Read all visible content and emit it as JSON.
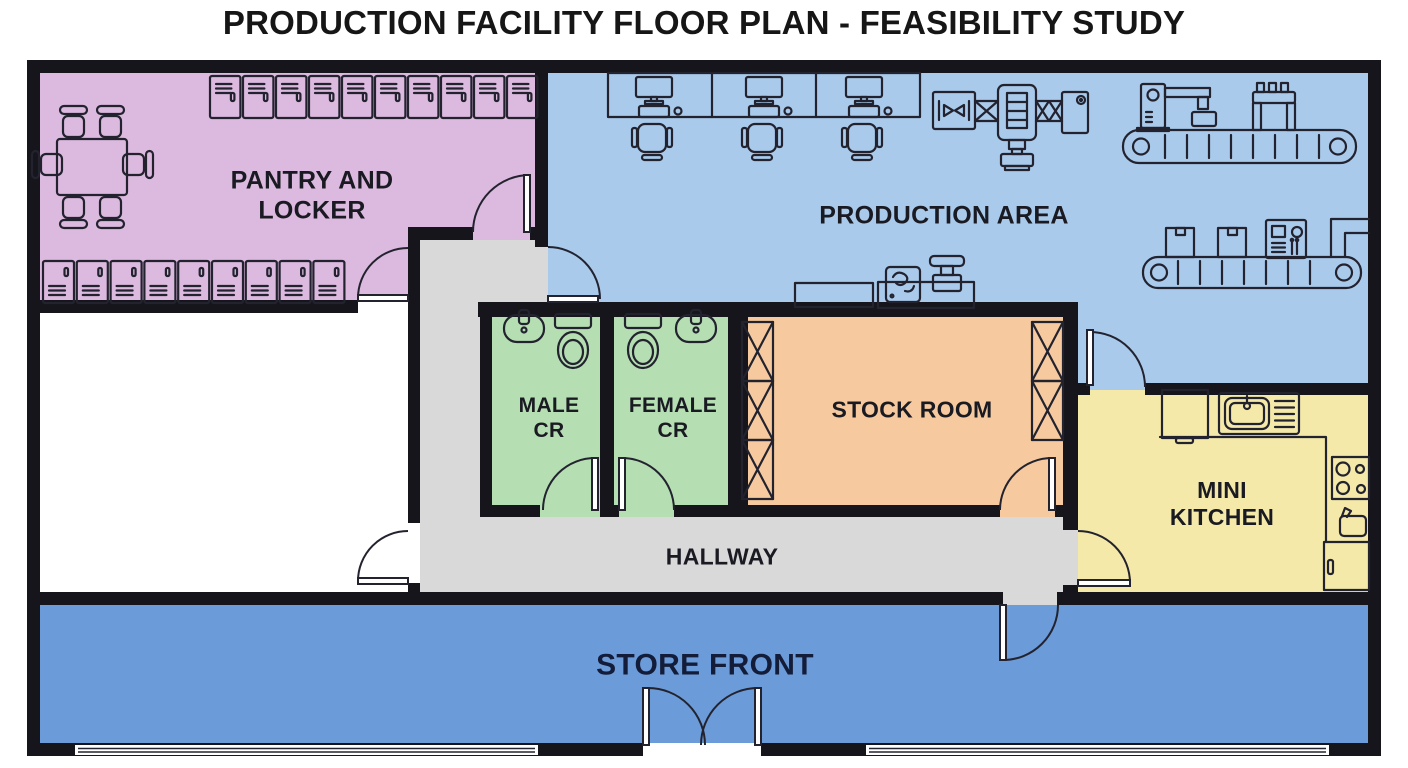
{
  "title": "PRODUCTION FACILITY FLOOR PLAN - FEASIBILITY STUDY",
  "rooms": {
    "pantry_locker": {
      "label": "PANTRY AND\nLOCKER",
      "color": "#dcb9df"
    },
    "production_area": {
      "label": "PRODUCTION AREA",
      "color": "#a9caeb"
    },
    "male_cr": {
      "label": "MALE\nCR",
      "color": "#b6deb3"
    },
    "female_cr": {
      "label": "FEMALE\nCR",
      "color": "#b6deb3"
    },
    "stock_room": {
      "label": "STOCK ROOM",
      "color": "#f6ca9e"
    },
    "mini_kitchen": {
      "label": "MINI\nKITCHEN",
      "color": "#f5e9a9"
    },
    "hallway": {
      "label": "HALLWAY",
      "color": "#d9d9da"
    },
    "store_front": {
      "label": "STORE FRONT",
      "color": "#6b9bd9"
    },
    "unlabeled_room": {
      "label": "",
      "color": "#ffffff"
    }
  },
  "colors": {
    "wall": "#15151b",
    "furniture_outline": "#23232f",
    "door": "#ffffff",
    "window": "#ffffff",
    "label_text": "#1a1a22",
    "store_front_label_text": "#131c38"
  },
  "furniture": {
    "pantry": {
      "lockers_top": {
        "count": 10
      },
      "lockers_bottom": {
        "count": 9
      },
      "icons": [
        "conference-table-icon",
        "chair-icon",
        "locker-icon"
      ]
    },
    "production": {
      "workstations": {
        "count": 3
      },
      "icons": [
        "desk-icon",
        "monitor-icon",
        "keyboard-icon",
        "mouse-icon",
        "office-chair-icon",
        "assembly-line-machine-icon",
        "press-machine-icon",
        "robot-arm-icon",
        "scanner-gantry-icon",
        "conveyor-belt-icon",
        "box-icon",
        "control-panel-icon",
        "work-table-icon",
        "mixer-pump-icon",
        "stamping-tool-icon",
        "duct-icon"
      ]
    },
    "stock_room": {
      "shelf_units": {
        "left": 3,
        "right": 2
      },
      "icons": [
        "x-brace-shelf-icon"
      ]
    },
    "male_cr": {
      "icons": [
        "sink-icon",
        "toilet-icon"
      ]
    },
    "female_cr": {
      "icons": [
        "toilet-icon",
        "sink-icon"
      ]
    },
    "mini_kitchen": {
      "icons": [
        "cabinet-icon",
        "kitchen-sink-icon",
        "counter-icon",
        "stove-icon",
        "kettle-icon",
        "fridge-icon"
      ]
    },
    "store_front": {
      "icons": [
        "double-entry-door-icon",
        "storefront-window-icon"
      ]
    }
  }
}
